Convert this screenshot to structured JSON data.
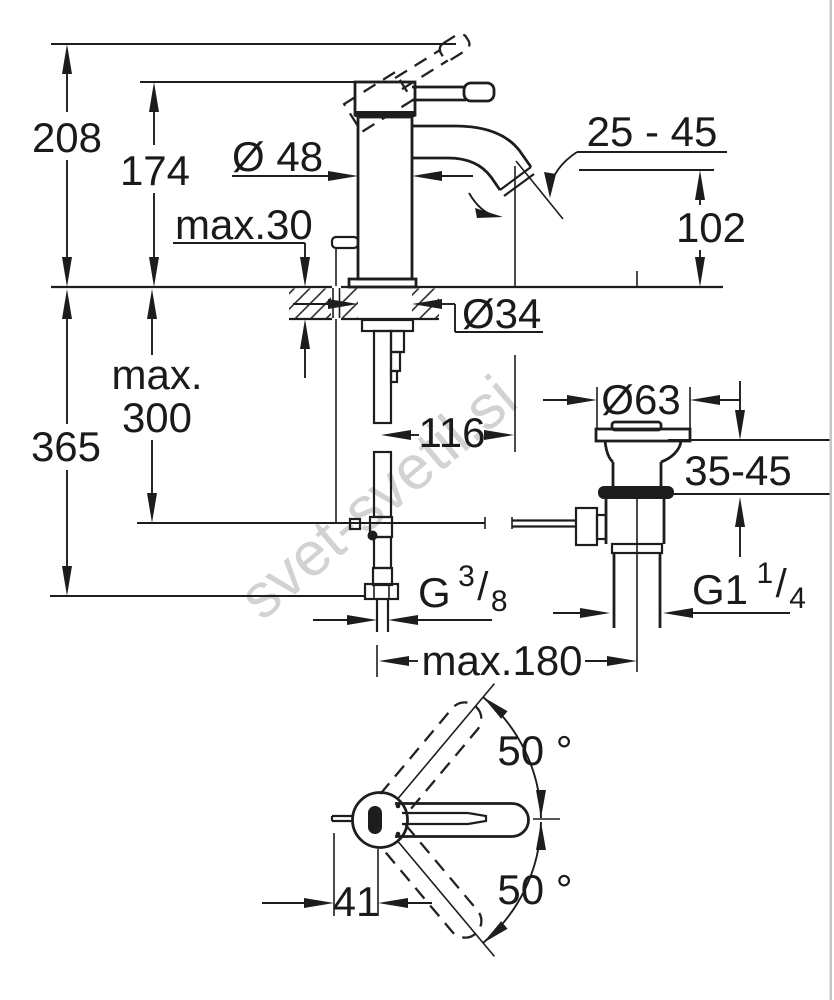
{
  "watermark": "svet-svetil.si",
  "labels": {
    "total_height": "208",
    "body_height": "174",
    "body_diameter": "Ø 48",
    "deck_thickness": "max.30",
    "aerator_angle_range": "25 - 45",
    "spout_height": "102",
    "hole_diameter": "Ø34",
    "hose_length_max_word": "max.",
    "hose_length_max_value": "300",
    "install_height": "365",
    "hose_to_outlet": "116",
    "waste_flange_diameter": "Ø63",
    "waste_deck_range": "35-45",
    "rod_to_waste_distance": "max.180",
    "handle_swivel_up": "50 °",
    "handle_swivel_down": "50 °",
    "handle_offset": "41",
    "supply_thread": {
      "base": "G",
      "sup": "3",
      "slash": "/",
      "sub": "8"
    },
    "waste_thread": {
      "base": "G1",
      "sup": "1",
      "slash": "/",
      "sub": "4"
    }
  }
}
